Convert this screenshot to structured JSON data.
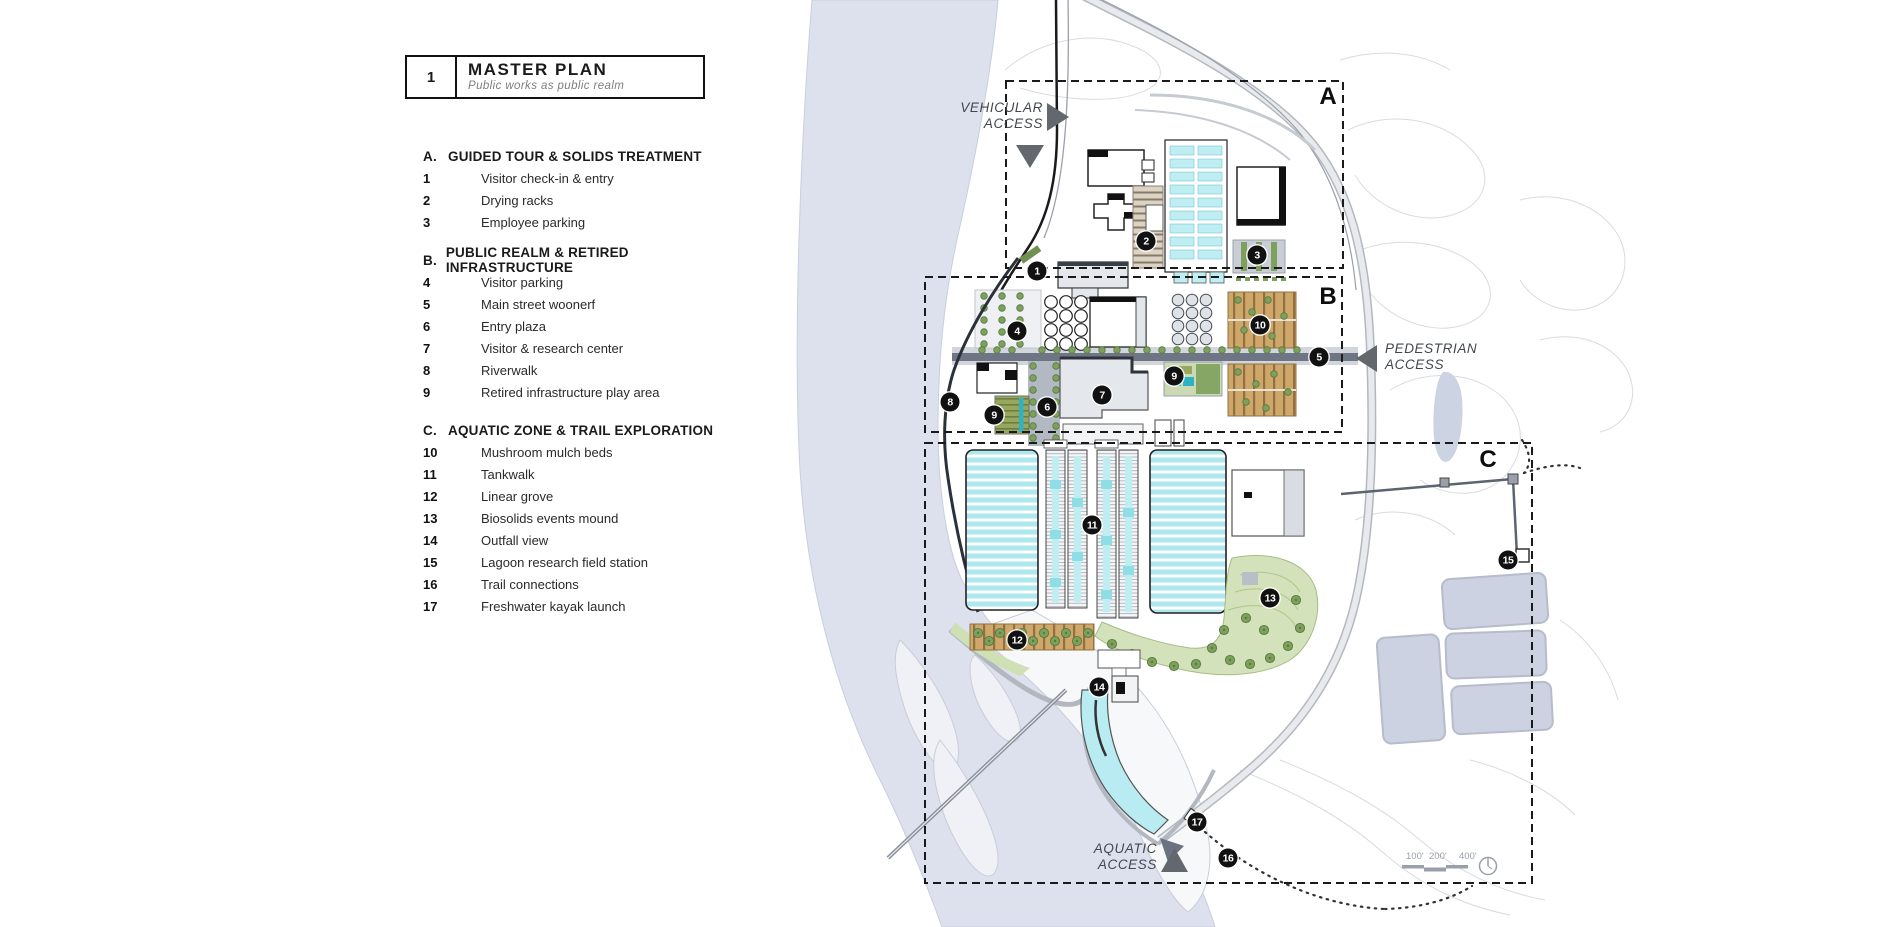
{
  "title_block": {
    "number": "1",
    "title": "MASTER PLAN",
    "subtitle": "Public works as public realm"
  },
  "legend": {
    "sections": [
      {
        "letter": "A.",
        "title": "GUIDED TOUR & SOLIDS TREATMENT",
        "items": [
          {
            "num": "1",
            "label": "Visitor check-in & entry"
          },
          {
            "num": "2",
            "label": "Drying racks"
          },
          {
            "num": "3",
            "label": "Employee parking"
          }
        ]
      },
      {
        "letter": "B.",
        "title": "PUBLIC REALM & RETIRED INFRASTRUCTURE",
        "items": [
          {
            "num": "4",
            "label": "Visitor parking"
          },
          {
            "num": "5",
            "label": "Main street woonerf"
          },
          {
            "num": "6",
            "label": "Entry plaza"
          },
          {
            "num": "7",
            "label": "Visitor & research center"
          },
          {
            "num": "8",
            "label": "Riverwalk"
          },
          {
            "num": "9",
            "label": "Retired infrastructure play area"
          }
        ]
      },
      {
        "letter": "C.",
        "title": "AQUATIC ZONE & TRAIL EXPLORATION",
        "items": [
          {
            "num": "10",
            "label": "Mushroom mulch beds"
          },
          {
            "num": "11",
            "label": "Tankwalk"
          },
          {
            "num": "12",
            "label": "Linear grove"
          },
          {
            "num": "13",
            "label": "Biosolids events mound"
          },
          {
            "num": "14",
            "label": "Outfall view"
          },
          {
            "num": "15",
            "label": "Lagoon research field station"
          },
          {
            "num": "16",
            "label": "Trail connections"
          },
          {
            "num": "17",
            "label": "Freshwater kayak launch"
          }
        ]
      }
    ]
  },
  "map": {
    "zone_labels": [
      {
        "letter": "A",
        "x": 1328,
        "y": 97
      },
      {
        "letter": "B",
        "x": 1328,
        "y": 297
      },
      {
        "letter": "C",
        "x": 1488,
        "y": 460
      }
    ],
    "access_labels": [
      {
        "name": "vehicular-access",
        "line1": "VEHICULAR",
        "line2": "ACCESS"
      },
      {
        "name": "pedestrian-access",
        "line1": "PEDESTRIAN",
        "line2": "ACCESS"
      },
      {
        "name": "aquatic-access",
        "line1": "AQUATIC",
        "line2": "ACCESS"
      }
    ],
    "markers": [
      {
        "n": "1",
        "x": 1037,
        "y": 271
      },
      {
        "n": "2",
        "x": 1146,
        "y": 241
      },
      {
        "n": "3",
        "x": 1257,
        "y": 255
      },
      {
        "n": "4",
        "x": 1017,
        "y": 331
      },
      {
        "n": "5",
        "x": 1319,
        "y": 357
      },
      {
        "n": "6",
        "x": 1047,
        "y": 407
      },
      {
        "n": "7",
        "x": 1102,
        "y": 395
      },
      {
        "n": "8",
        "x": 950,
        "y": 402
      },
      {
        "n": "9",
        "x": 994,
        "y": 415
      },
      {
        "n": "9",
        "x": 1174,
        "y": 376
      },
      {
        "n": "10",
        "x": 1260,
        "y": 325
      },
      {
        "n": "11",
        "x": 1092,
        "y": 525
      },
      {
        "n": "12",
        "x": 1017,
        "y": 640
      },
      {
        "n": "13",
        "x": 1270,
        "y": 598
      },
      {
        "n": "14",
        "x": 1099,
        "y": 687
      },
      {
        "n": "15",
        "x": 1508,
        "y": 560
      },
      {
        "n": "16",
        "x": 1228,
        "y": 858
      },
      {
        "n": "17",
        "x": 1197,
        "y": 822
      }
    ],
    "scale_bar": {
      "labels": [
        "100'",
        "200'",
        "400'"
      ]
    },
    "colors": {
      "river": "#dce1ed",
      "treatment_water": "#bfeef2",
      "lagoon": "#ccd2e2",
      "tree_green": "#7da05c",
      "lawn_green": "#d3e2ba",
      "mulch_tan": "#cfa76b",
      "woonerf": "#6e7686",
      "marker": "#111111",
      "zone_boundary": "#1a1a1a"
    }
  }
}
